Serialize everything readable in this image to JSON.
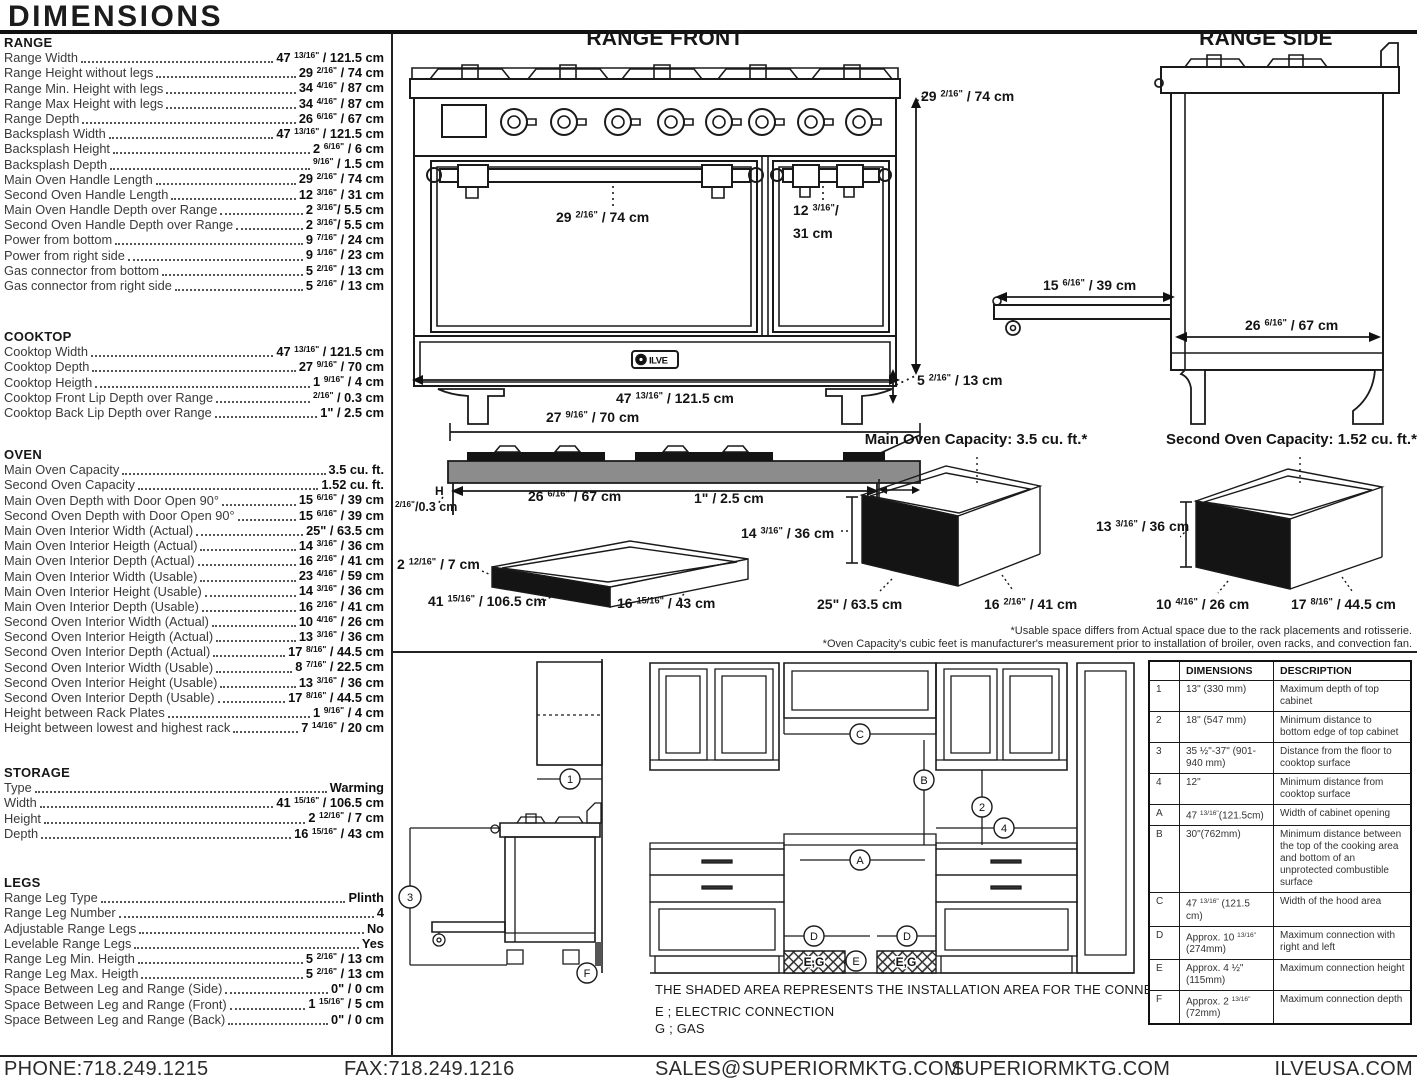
{
  "title": "DIMENSIONS",
  "specs": {
    "range": {
      "title": "RANGE",
      "rows": [
        {
          "label": "Range Width",
          "value": "47 13/16\" / 121.5 cm"
        },
        {
          "label": "Range Height without legs",
          "value": "29 2/16\" / 74 cm"
        },
        {
          "label": "Range Min. Height with legs",
          "value": "34 4/16\" / 87 cm"
        },
        {
          "label": "Range Max Height with legs",
          "value": "34 4/16\" / 87 cm"
        },
        {
          "label": "Range Depth",
          "value": "26 6/16\" / 67 cm"
        },
        {
          "label": "Backsplash Width",
          "value": "47 13/16\" / 121.5 cm"
        },
        {
          "label": "Backsplash Height",
          "value": "2 6/16\" / 6 cm"
        },
        {
          "label": "Backsplash Depth",
          "value": "9/16\" / 1.5 cm"
        },
        {
          "label": "Main Oven Handle Length",
          "value": "29 2/16\" / 74 cm"
        },
        {
          "label": "Second Oven Handle Length",
          "value": "12 3/16\" / 31 cm"
        },
        {
          "label": "Main Oven Handle Depth over Range",
          "value": "2 3/16\"/ 5.5 cm"
        },
        {
          "label": "Second Oven Handle Depth over Range",
          "value": "2 3/16\"/ 5.5 cm"
        },
        {
          "label": "Power from bottom",
          "value": "9 7/16\" / 24 cm"
        },
        {
          "label": "Power from right side",
          "value": "9 1/16\" / 23 cm"
        },
        {
          "label": "Gas connector from bottom",
          "value": "5 2/16\" / 13 cm"
        },
        {
          "label": "Gas connector from right side",
          "value": "5 2/16\" / 13 cm"
        }
      ]
    },
    "cooktop": {
      "title": "COOKTOP",
      "rows": [
        {
          "label": "Cooktop Width",
          "value": "47 13/16\" / 121.5 cm"
        },
        {
          "label": "Cooktop Depth",
          "value": "27 9/16\" / 70 cm"
        },
        {
          "label": "Cooktop Heigth",
          "value": "1 9/16\" / 4 cm"
        },
        {
          "label": "Cooktop Front Lip Depth over Range",
          "value": "2/16\" / 0.3 cm"
        },
        {
          "label": "Cooktop Back Lip Depth over Range",
          "value": "1\" / 2.5 cm"
        }
      ]
    },
    "oven": {
      "title": "OVEN",
      "rows": [
        {
          "label": "Main Oven Capacity",
          "value": "3.5 cu. ft."
        },
        {
          "label": "Second Oven Capacity",
          "value": "1.52 cu. ft."
        },
        {
          "label": "Main Oven Depth with Door Open 90°",
          "value": "15 6/16\" / 39 cm"
        },
        {
          "label": "Second Oven Depth with Door Open 90°",
          "value": "15 6/16\" / 39 cm"
        },
        {
          "label": "Main Oven Interior Width (Actual)",
          "value": "25\" / 63.5 cm"
        },
        {
          "label": "Main Oven Interior Heigth (Actual)",
          "value": "14 3/16\" / 36 cm"
        },
        {
          "label": "Main Oven Interior Depth (Actual)",
          "value": "16 2/16\" / 41 cm"
        },
        {
          "label": "Main Oven Interior Width (Usable)",
          "value": "23 4/16\" / 59 cm"
        },
        {
          "label": "Main Oven Interior Height (Usable)",
          "value": "14 3/16\" / 36 cm"
        },
        {
          "label": "Main Oven Interior Depth (Usable)",
          "value": "16 2/16\" / 41 cm"
        },
        {
          "label": "Second Oven Interior Width (Actual)",
          "value": "10 4/16\" / 26 cm"
        },
        {
          "label": "Second Oven Interior Heigth (Actual)",
          "value": "13 3/16\" / 36 cm"
        },
        {
          "label": "Second Oven Interior Depth (Actual)",
          "value": "17 8/16\" / 44.5 cm"
        },
        {
          "label": "Second Oven Interior Width (Usable)",
          "value": "8 7/16\" / 22.5 cm"
        },
        {
          "label": "Second Oven Interior Height (Usable)",
          "value": "13 3/16\" / 36 cm"
        },
        {
          "label": "Second Oven Interior Depth (Usable)",
          "value": "17 8/16\" / 44.5 cm"
        },
        {
          "label": "Height between Rack Plates",
          "value": "1 9/16\" / 4 cm"
        },
        {
          "label": "Height between lowest and highest rack",
          "value": "7 14/16\" / 20 cm"
        }
      ]
    },
    "storage": {
      "title": "STORAGE",
      "rows": [
        {
          "label": "Type",
          "value": "Warming"
        },
        {
          "label": "Width",
          "value": "41 15/16\" / 106.5 cm"
        },
        {
          "label": "Height",
          "value": "2 12/16\" / 7 cm"
        },
        {
          "label": "Depth",
          "value": "16 15/16\" / 43 cm"
        }
      ]
    },
    "legs": {
      "title": "LEGS",
      "rows": [
        {
          "label": "Range Leg Type",
          "value": "Plinth"
        },
        {
          "label": "Range Leg Number",
          "value": "4"
        },
        {
          "label": "Adjustable Range Legs",
          "value": "No"
        },
        {
          "label": "Levelable Range Legs",
          "value": "Yes"
        },
        {
          "label": "Range Leg Min. Heigth",
          "value": "5 2/16\" / 13 cm"
        },
        {
          "label": "Range Leg Max. Heigth",
          "value": "5 2/16\" / 13 cm"
        },
        {
          "label": "Space Between Leg and Range (Side)",
          "value": "0\" / 0 cm"
        },
        {
          "label": "Space Between Leg and Range (Front)",
          "value": "1 15/16\" / 5 cm"
        },
        {
          "label": "Space Between Leg and Range (Back)",
          "value": "0\" / 0 cm"
        }
      ]
    }
  },
  "front": {
    "title": "RANGE FRONT",
    "height": "29 2/16\" / 74 cm",
    "main_handle": "29 2/16\" / 74 cm",
    "second_handle_l1": "12 3/16\"/",
    "second_handle_l2": "31 cm",
    "width": "47 13/16\" / 121.5 cm",
    "leg_height": "5 2/16\" / 13 cm"
  },
  "side": {
    "title": "RANGE SIDE",
    "door_open": "15 6/16\" / 39 cm",
    "depth": "26 6/16\" / 67 cm"
  },
  "cooktop_diagram": {
    "width": "27 9/16\" / 70 cm",
    "inner_width": "26 6/16\" / 67 cm",
    "back_lip": "1\" / 2.5 cm",
    "front_lip": "2/16\"/0.3 cm",
    "h_marker": "H"
  },
  "drawer_diagram": {
    "height": "2 12/16\" / 7 cm",
    "width": "41 15/16\" / 106.5 cm",
    "depth": "16 15/16\" / 43 cm"
  },
  "main_oven_diagram": {
    "title": "Main Oven Capacity: 3.5 cu. ft.*",
    "height": "14 3/16\" / 36 cm",
    "width": "25\" / 63.5 cm",
    "depth": "16 2/16\" / 41 cm"
  },
  "second_oven_diagram": {
    "title": "Second Oven Capacity: 1.52 cu. ft.*",
    "height": "13 3/16\" / 36 cm",
    "width": "10 4/16\" / 26 cm",
    "depth": "17 8/16\" / 44.5 cm"
  },
  "footnotes": [
    "*Usable space differs from Actual space due to the rack placements and rotisserie.",
    "*Oven Capacity's cubic feet is manufacturer's measurement prior to installation of broiler, oven racks, and convection fan."
  ],
  "install": {
    "note": "THE SHADED AREA REPRESENTS THE INSTALLATION AREA FOR THE CONNECTIONS;",
    "electric": "E ; ELECTRIC CONNECTION",
    "gas": "G ; GAS",
    "eg": "E,G",
    "m1": "1",
    "m2": "2",
    "m3": "3",
    "m4": "4",
    "mA": "A",
    "mB": "B",
    "mC": "C",
    "mD": "D",
    "mE": "E",
    "mF": "F"
  },
  "table": {
    "headers": [
      "",
      "DIMENSIONS",
      "DESCRIPTION"
    ],
    "rows": [
      {
        "id": "1",
        "dim": "13\" (330 mm)",
        "desc": "Maximum depth of top cabinet"
      },
      {
        "id": "2",
        "dim": "18\" (547 mm)",
        "desc": "Minimum distance to bottom edge of top cabinet"
      },
      {
        "id": "3",
        "dim": "35 ½\"-37\" (901-940 mm)",
        "desc": "Distance from the floor to cooktop surface"
      },
      {
        "id": "4",
        "dim": "12\"",
        "desc": "Minimum distance from cooktop surface"
      },
      {
        "id": "A",
        "dim": "47 13/16\"(121.5cm)",
        "desc": "Width of cabinet opening"
      },
      {
        "id": "B",
        "dim": "30\"(762mm)",
        "desc": "Minimum distance between the top of the cooking area and bottom of an unprotected combustible surface"
      },
      {
        "id": "C",
        "dim": "47 13/16\" (121.5 cm)",
        "desc": "Width of the hood area"
      },
      {
        "id": "D",
        "dim": "Approx. 10 13/16\" (274mm)",
        "desc": "Maximum connection with right and left"
      },
      {
        "id": "E",
        "dim": "Approx. 4 ½\" (115mm)",
        "desc": "Maximum connection height"
      },
      {
        "id": "F",
        "dim": "Approx. 2 13/16\" (72mm)",
        "desc": "Maximum connection depth"
      }
    ]
  },
  "brand": "ILVE",
  "footer": {
    "phone": "PHONE:718.249.1215",
    "fax": "FAX:718.249.1216",
    "sales": "SALES@SUPERIORMKTG.COM",
    "site": "SUPERIORMKTG.COM",
    "ilve": "ILVEUSA.COM"
  }
}
